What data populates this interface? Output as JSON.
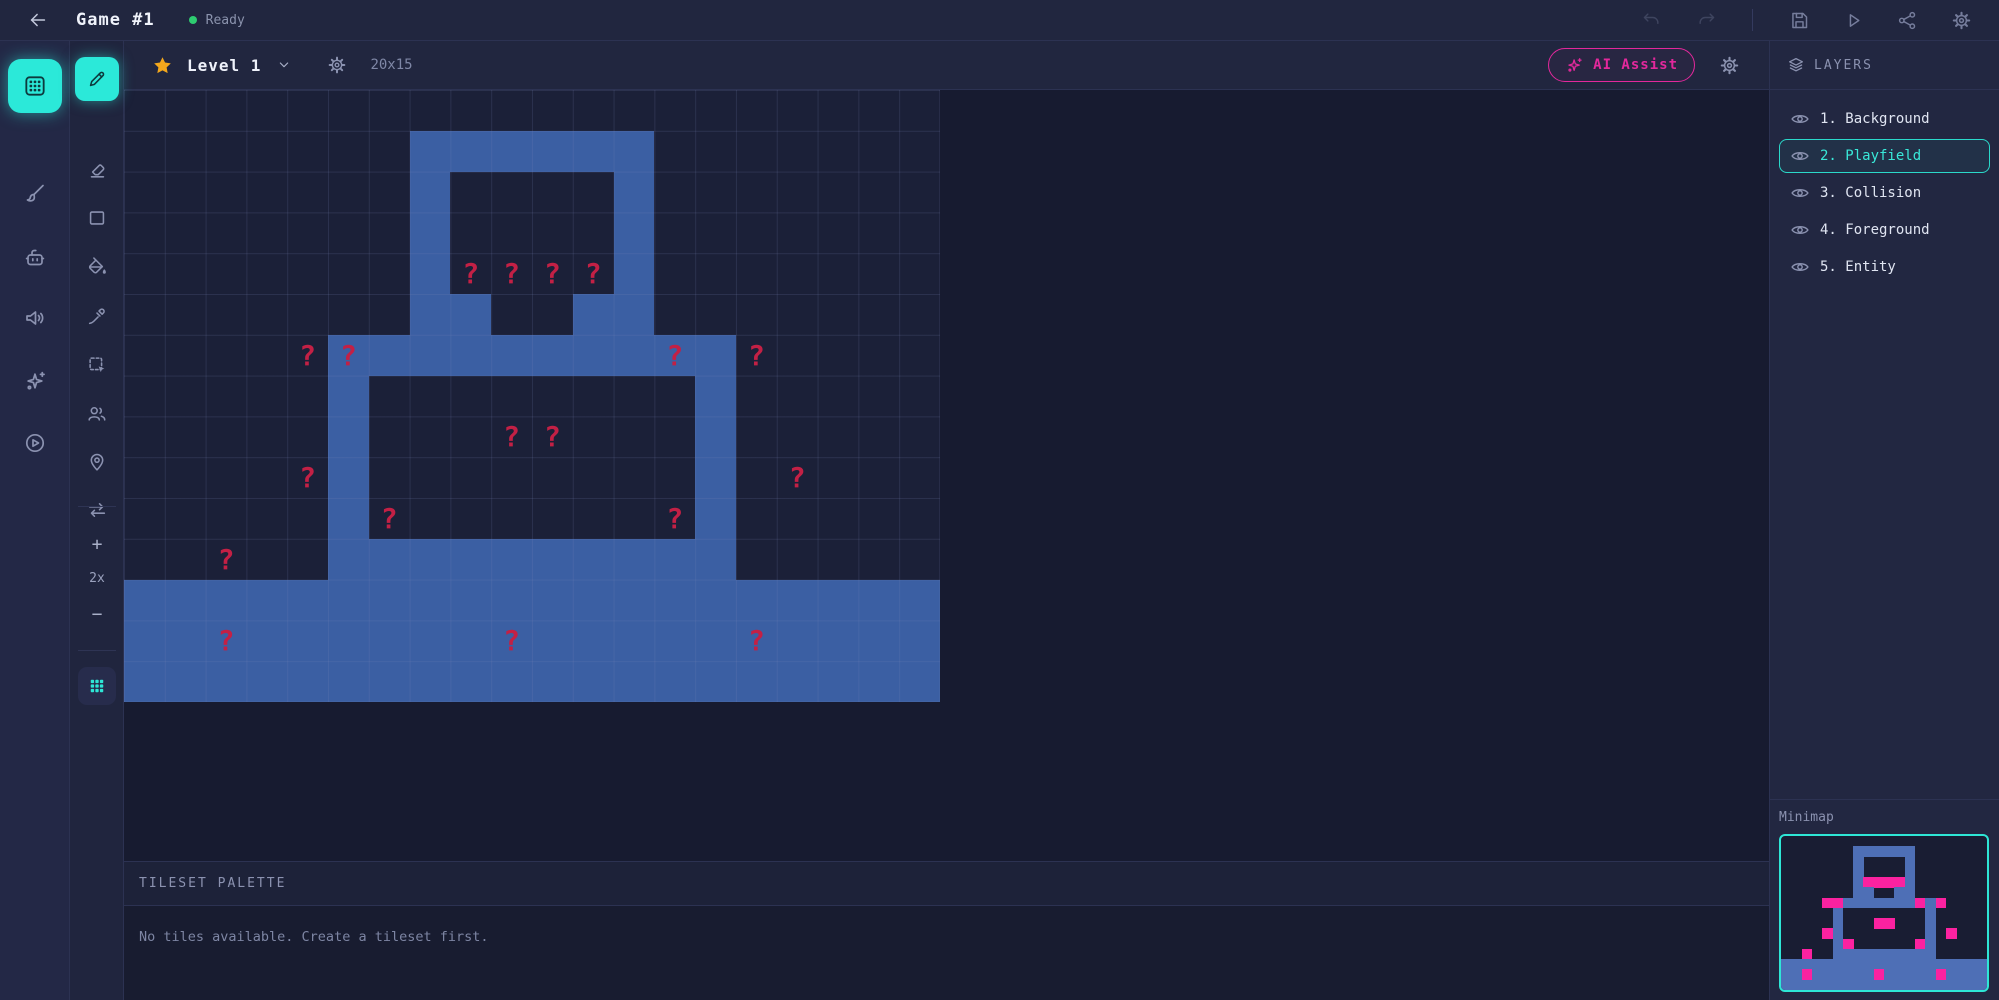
{
  "topbar": {
    "title": "Game #1",
    "status": "Ready"
  },
  "level_toolbar": {
    "level_name": "Level 1",
    "grid_size": "20x15",
    "ai_assist_label": "AI Assist"
  },
  "sidebar_outer": {
    "items": [
      {
        "name": "tiles-tool",
        "icon": "grid-icon",
        "active": true
      },
      {
        "name": "paint-tool",
        "icon": "brush-icon",
        "active": false
      },
      {
        "name": "robot-tool",
        "icon": "robot-icon",
        "active": false
      },
      {
        "name": "audio-tool",
        "icon": "speaker-icon",
        "active": false
      },
      {
        "name": "ai-tool",
        "icon": "sparkles-icon",
        "active": false
      },
      {
        "name": "preview-tool",
        "icon": "play-circle-icon",
        "active": false
      }
    ]
  },
  "tool_rail": {
    "tools": [
      {
        "name": "pencil-tool",
        "icon": "pencil-icon",
        "active": true
      },
      {
        "name": "eraser-tool",
        "icon": "eraser-icon",
        "active": false
      },
      {
        "name": "rectangle-tool",
        "icon": "rectangle-icon",
        "active": false
      },
      {
        "name": "fill-tool",
        "icon": "paint-bucket-icon",
        "active": false
      },
      {
        "name": "eyedropper-tool",
        "icon": "eyedropper-icon",
        "active": false
      },
      {
        "name": "select-tool",
        "icon": "select-icon",
        "active": false
      },
      {
        "name": "entities-tool",
        "icon": "users-icon",
        "active": false
      },
      {
        "name": "location-tool",
        "icon": "pin-icon",
        "active": false
      },
      {
        "name": "swap-tool",
        "icon": "swap-icon",
        "active": false
      }
    ],
    "zoom": {
      "in_label": "+",
      "level": "2x",
      "out_label": "−"
    },
    "grid_toggle_icon": "grid-icon"
  },
  "layers": {
    "header": "LAYERS",
    "items": [
      {
        "label": "1. Background",
        "selected": false
      },
      {
        "label": "2. Playfield",
        "selected": true
      },
      {
        "label": "3. Collision",
        "selected": false
      },
      {
        "label": "4. Foreground",
        "selected": false
      },
      {
        "label": "5. Entity",
        "selected": false
      }
    ]
  },
  "minimap": {
    "label": "Minimap"
  },
  "palette": {
    "header": "TILESET PALETTE",
    "empty_message": "No tiles available. Create a tileset first."
  },
  "canvas": {
    "cols": 20,
    "rows": 15,
    "zoom_level": "2x",
    "qmark_char": "?",
    "legend": {
      ".": "empty",
      "#": "tile",
      "q": "question-mark-on-empty",
      "Q": "question-mark-on-tile"
    },
    "tilemap": [
      "....................",
      ".......######.......",
      ".......#....#.......",
      ".......#....#.......",
      ".......#qqqq#.......",
      ".......##..##.......",
      "....qQ#######Q#q....",
      ".....#........#.....",
      ".....#...qq...#.....",
      "....q#........#.q...",
      ".....#q......q#.....",
      "..q..##########.....",
      "####################",
      "##Q######Q#####Q####",
      "####################"
    ]
  },
  "colors": {
    "accent_cyan": "#2be9d9",
    "accent_pink": "#e3289c",
    "tile_blue": "#3b5fa3",
    "qmark_red": "#c32045",
    "minimap_tile": "#4e6fb6",
    "minimap_marker": "#fb22a0",
    "status_green": "#2ecc71",
    "star_gold": "#f3a71c"
  }
}
